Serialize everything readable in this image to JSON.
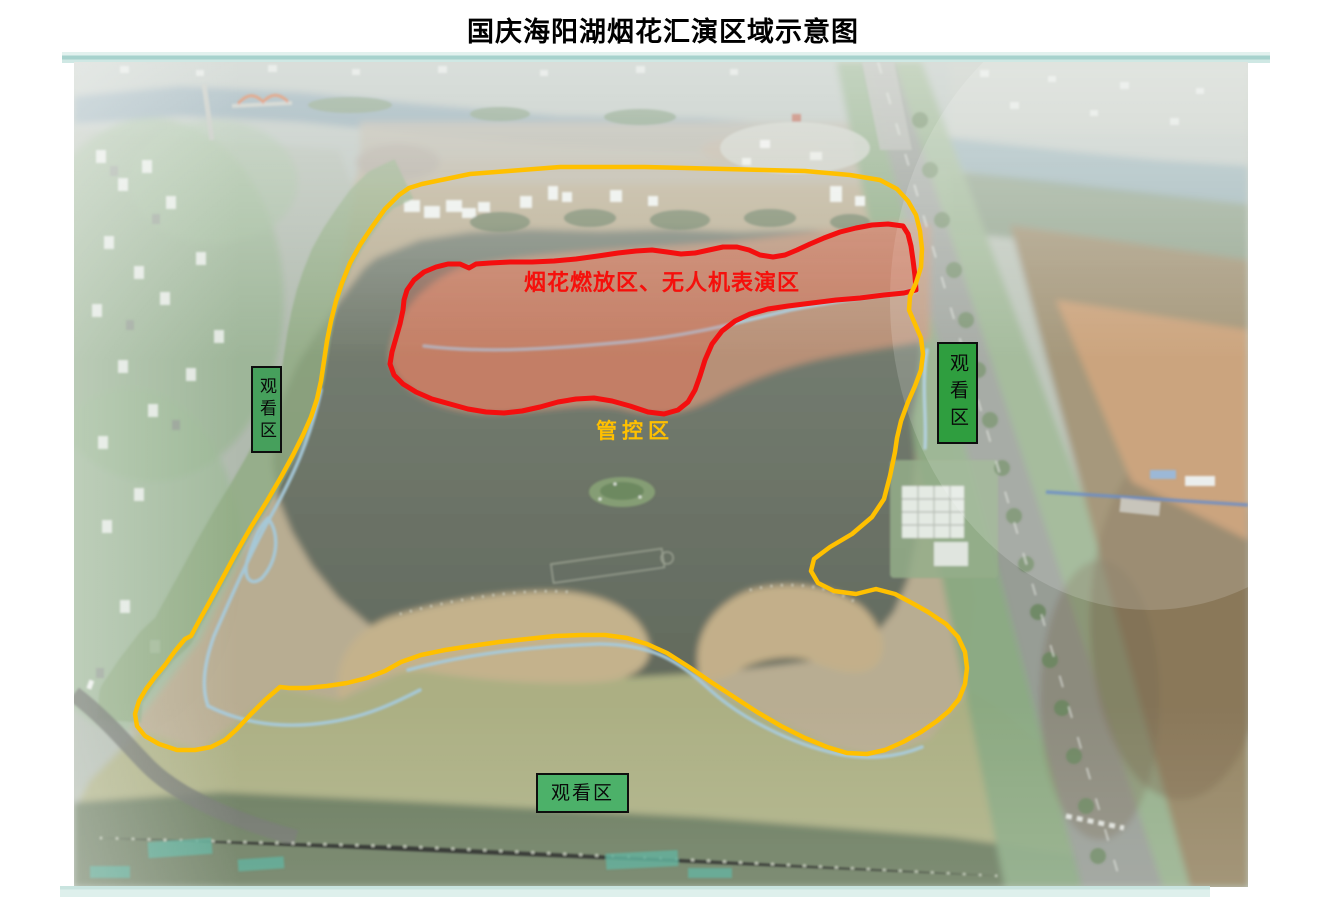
{
  "title": "国庆海阳湖烟花汇演区域示意图",
  "zones": {
    "fireworks_drone": {
      "label": "烟花燃放区、无人机表演区",
      "outline_color": "#F5100C"
    },
    "control": {
      "label": "管控区",
      "outline_color": "#FFC000"
    },
    "viewing": {
      "label": "观看区",
      "box_fills": [
        "#46A05C",
        "#2F9E3F",
        "#4CB169"
      ],
      "border_color": "#0E0E0E"
    }
  },
  "decor": {
    "top_bar_color": "#A7D2CD",
    "bottom_bar_color": "#DEF0EC"
  }
}
